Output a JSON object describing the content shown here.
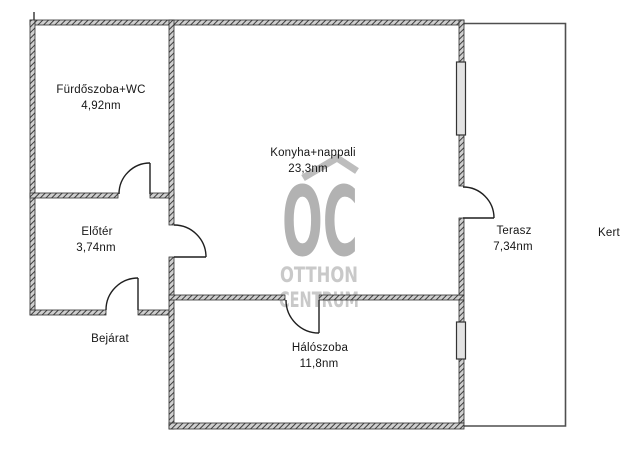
{
  "rooms": {
    "bathroom": {
      "name": "Fürdőszoba+WC",
      "area": "4,92nm"
    },
    "hall": {
      "name": "Előtér",
      "area": "3,74nm"
    },
    "kitchen_living": {
      "name": "Konyha+nappali",
      "area": "23,3nm"
    },
    "bedroom": {
      "name": "Hálószoba",
      "area": "11,8nm"
    },
    "terrace": {
      "name": "Terasz",
      "area": "7,34nm"
    }
  },
  "labels": {
    "entrance": "Bejárat",
    "garden": "Kert"
  },
  "watermark": {
    "logo": "OC",
    "line1": "OTTHON",
    "line2": "CENTRUM"
  },
  "colors": {
    "wall_dark": "#3f3f3f",
    "wall_light": "#cfcfcf",
    "wall_outline": "#2f2f2f",
    "door_line": "#1f1f1f",
    "thin_line": "#4f4f4f",
    "window_fill": "#e3e3e3",
    "watermark_logo": "#b2b2b2",
    "watermark_text": "#c9c9c9",
    "label_text": "#161616",
    "background": "#ffffff"
  }
}
